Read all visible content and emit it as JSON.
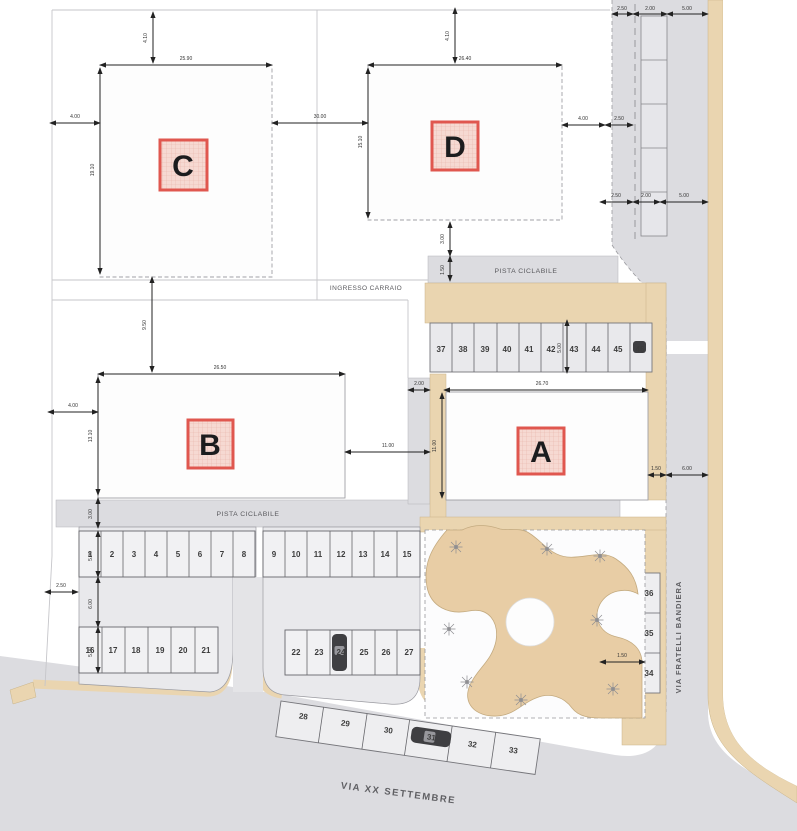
{
  "buildings": {
    "a": "A",
    "b": "B",
    "c": "C",
    "d": "D"
  },
  "streets": {
    "via_xx_settembre": "VIA XX SETTEMBRE",
    "via_fratelli_bandiera": "VIA FRATELLI BANDIERA"
  },
  "area_labels": {
    "bike_path_north": "PISTA CICLABILE",
    "bike_path_south": "PISTA CICLABILE",
    "driveway_entrance": "INGRESSO CARRAIO"
  },
  "parking_stalls": [
    {
      "n": "1",
      "x": 90,
      "y": 557
    },
    {
      "n": "2",
      "x": 112,
      "y": 557
    },
    {
      "n": "3",
      "x": 134,
      "y": 557
    },
    {
      "n": "4",
      "x": 156,
      "y": 557
    },
    {
      "n": "5",
      "x": 178,
      "y": 557
    },
    {
      "n": "6",
      "x": 200,
      "y": 557
    },
    {
      "n": "7",
      "x": 222,
      "y": 557
    },
    {
      "n": "8",
      "x": 244,
      "y": 557
    },
    {
      "n": "9",
      "x": 274,
      "y": 557
    },
    {
      "n": "10",
      "x": 296,
      "y": 557
    },
    {
      "n": "11",
      "x": 318,
      "y": 557
    },
    {
      "n": "12",
      "x": 341,
      "y": 557
    },
    {
      "n": "13",
      "x": 363,
      "y": 557
    },
    {
      "n": "14",
      "x": 385,
      "y": 557
    },
    {
      "n": "15",
      "x": 407,
      "y": 557
    },
    {
      "n": "16",
      "x": 90,
      "y": 653
    },
    {
      "n": "17",
      "x": 113,
      "y": 653
    },
    {
      "n": "18",
      "x": 136,
      "y": 653
    },
    {
      "n": "19",
      "x": 160,
      "y": 653
    },
    {
      "n": "20",
      "x": 183,
      "y": 653
    },
    {
      "n": "21",
      "x": 206,
      "y": 653
    },
    {
      "n": "22",
      "x": 296,
      "y": 655
    },
    {
      "n": "23",
      "x": 319,
      "y": 655
    },
    {
      "n": "24",
      "x": 341,
      "y": 655
    },
    {
      "n": "25",
      "x": 364,
      "y": 655
    },
    {
      "n": "26",
      "x": 386,
      "y": 655
    },
    {
      "n": "27",
      "x": 409,
      "y": 655
    },
    {
      "n": "28",
      "x": 303,
      "y": 719,
      "rot": 8
    },
    {
      "n": "29",
      "x": 345,
      "y": 726,
      "rot": 8
    },
    {
      "n": "30",
      "x": 388,
      "y": 733,
      "rot": 8
    },
    {
      "n": "31",
      "x": 431,
      "y": 740,
      "rot": 8
    },
    {
      "n": "32",
      "x": 472,
      "y": 747,
      "rot": 8
    },
    {
      "n": "33",
      "x": 513,
      "y": 753,
      "rot": 8
    },
    {
      "n": "34",
      "x": 649,
      "y": 676
    },
    {
      "n": "35",
      "x": 649,
      "y": 636
    },
    {
      "n": "36",
      "x": 649,
      "y": 596
    },
    {
      "n": "37",
      "x": 441,
      "y": 352
    },
    {
      "n": "38",
      "x": 463,
      "y": 352
    },
    {
      "n": "39",
      "x": 485,
      "y": 352
    },
    {
      "n": "40",
      "x": 507,
      "y": 352
    },
    {
      "n": "41",
      "x": 529,
      "y": 352
    },
    {
      "n": "42",
      "x": 551,
      "y": 352
    },
    {
      "n": "43",
      "x": 574,
      "y": 352
    },
    {
      "n": "44",
      "x": 596,
      "y": 352
    },
    {
      "n": "45",
      "x": 618,
      "y": 352
    },
    {
      "n": "46",
      "x": 640,
      "y": 352
    }
  ],
  "dimensions": [
    {
      "text": "4.10",
      "seg": [
        153,
        12,
        153,
        63
      ],
      "tx": 147,
      "ty": 38,
      "rot": -90
    },
    {
      "text": "25.90",
      "seg": [
        100,
        65,
        272,
        65
      ],
      "tx": 186,
      "ty": 60
    },
    {
      "text": "4.00",
      "seg": [
        50,
        123,
        100,
        123
      ],
      "tx": 75,
      "ty": 118
    },
    {
      "text": "19.10",
      "seg": [
        100,
        68,
        100,
        274
      ],
      "tx": 94,
      "ty": 170,
      "rot": -90
    },
    {
      "text": "9.50",
      "seg": [
        152,
        277,
        152,
        372
      ],
      "tx": 146,
      "ty": 325,
      "rot": -90
    },
    {
      "text": "30.00",
      "seg": [
        272,
        123,
        368,
        123
      ],
      "tx": 320,
      "ty": 118
    },
    {
      "text": "4.10",
      "seg": [
        455,
        8,
        455,
        63
      ],
      "tx": 449,
      "ty": 36,
      "rot": -90
    },
    {
      "text": "26.40",
      "seg": [
        368,
        65,
        562,
        65
      ],
      "tx": 465,
      "ty": 60
    },
    {
      "text": "15.10",
      "seg": [
        368,
        68,
        368,
        218
      ],
      "tx": 362,
      "ty": 142,
      "rot": -90
    },
    {
      "text": "4.00",
      "seg": [
        562,
        125,
        605,
        125
      ],
      "tx": 583,
      "ty": 120
    },
    {
      "text": "2.50",
      "seg": [
        605,
        125,
        633,
        125
      ],
      "tx": 619,
      "ty": 120
    },
    {
      "text": "3.00",
      "seg": [
        450,
        222,
        450,
        256
      ],
      "tx": 444,
      "ty": 239,
      "rot": -90
    },
    {
      "text": "1.50",
      "seg": [
        450,
        256,
        450,
        281
      ],
      "tx": 444,
      "ty": 270,
      "rot": -90
    },
    {
      "text": "26.50",
      "seg": [
        98,
        374,
        345,
        374
      ],
      "tx": 220,
      "ty": 369
    },
    {
      "text": "4.00",
      "seg": [
        48,
        412,
        98,
        412
      ],
      "tx": 73,
      "ty": 407
    },
    {
      "text": "13.10",
      "seg": [
        98,
        377,
        98,
        495
      ],
      "tx": 92,
      "ty": 436,
      "rot": -90
    },
    {
      "text": "3.00",
      "seg": [
        98,
        498,
        98,
        528
      ],
      "tx": 92,
      "ty": 514,
      "rot": -90
    },
    {
      "text": "11.00",
      "seg": [
        345,
        452,
        430,
        452
      ],
      "tx": 388,
      "ty": 447
    },
    {
      "text": "26.70",
      "seg": [
        444,
        390,
        648,
        390
      ],
      "tx": 542,
      "ty": 385
    },
    {
      "text": "2.00",
      "seg": [
        408,
        390,
        430,
        390
      ],
      "tx": 419,
      "ty": 385
    },
    {
      "text": "11.00",
      "seg": [
        442,
        393,
        442,
        498
      ],
      "tx": 436,
      "ty": 446,
      "rot": -90
    },
    {
      "text": "1.50",
      "seg": [
        648,
        475,
        666,
        475
      ],
      "tx": 656,
      "ty": 470
    },
    {
      "text": "6.00",
      "seg": [
        666,
        475,
        708,
        475
      ],
      "tx": 687,
      "ty": 470
    },
    {
      "text": "5.00",
      "seg": [
        567,
        320,
        567,
        373
      ],
      "tx": 561,
      "ty": 348,
      "rot": -90
    },
    {
      "text": "2.50",
      "seg": [
        600,
        202,
        633,
        202
      ],
      "tx": 616,
      "ty": 197
    },
    {
      "text": "2.00",
      "seg": [
        633,
        202,
        660,
        202
      ],
      "tx": 646,
      "ty": 197
    },
    {
      "text": "5.00",
      "seg": [
        660,
        202,
        708,
        202
      ],
      "tx": 684,
      "ty": 197
    },
    {
      "text": "5.00",
      "seg": [
        98,
        531,
        98,
        577
      ],
      "tx": 92,
      "ty": 556,
      "rot": -90
    },
    {
      "text": "6.00",
      "seg": [
        98,
        577,
        98,
        627
      ],
      "tx": 92,
      "ty": 604,
      "rot": -90
    },
    {
      "text": "5.00",
      "seg": [
        98,
        627,
        98,
        673
      ],
      "tx": 92,
      "ty": 652,
      "rot": -90
    },
    {
      "text": "2.50",
      "seg": [
        45,
        592,
        78,
        592
      ],
      "tx": 61,
      "ty": 587
    },
    {
      "text": "1.50",
      "seg": [
        600,
        662,
        645,
        662
      ],
      "tx": 622,
      "ty": 657
    },
    {
      "text": "2.50",
      "seg": [
        612,
        14,
        633,
        14
      ],
      "tx": 622,
      "ty": 10
    },
    {
      "text": "2.00",
      "seg": [
        633,
        14,
        667,
        14
      ],
      "tx": 650,
      "ty": 10
    },
    {
      "text": "5.00",
      "seg": [
        667,
        14,
        708,
        14
      ],
      "tx": 687,
      "ty": 10
    }
  ],
  "colors": {
    "road": "#dcdce0",
    "parking_island": "#e9e9ec",
    "stall_fill": "#f1f1f3",
    "path_tan": "#ead5b0",
    "playground_tan": "#e8cda5",
    "label_box_border": "#e0574f",
    "label_box_fill": "#f6d9d2",
    "dimension": "#222222",
    "stall_number": "#3c3c3c",
    "boundary": "#c6c6ca"
  }
}
